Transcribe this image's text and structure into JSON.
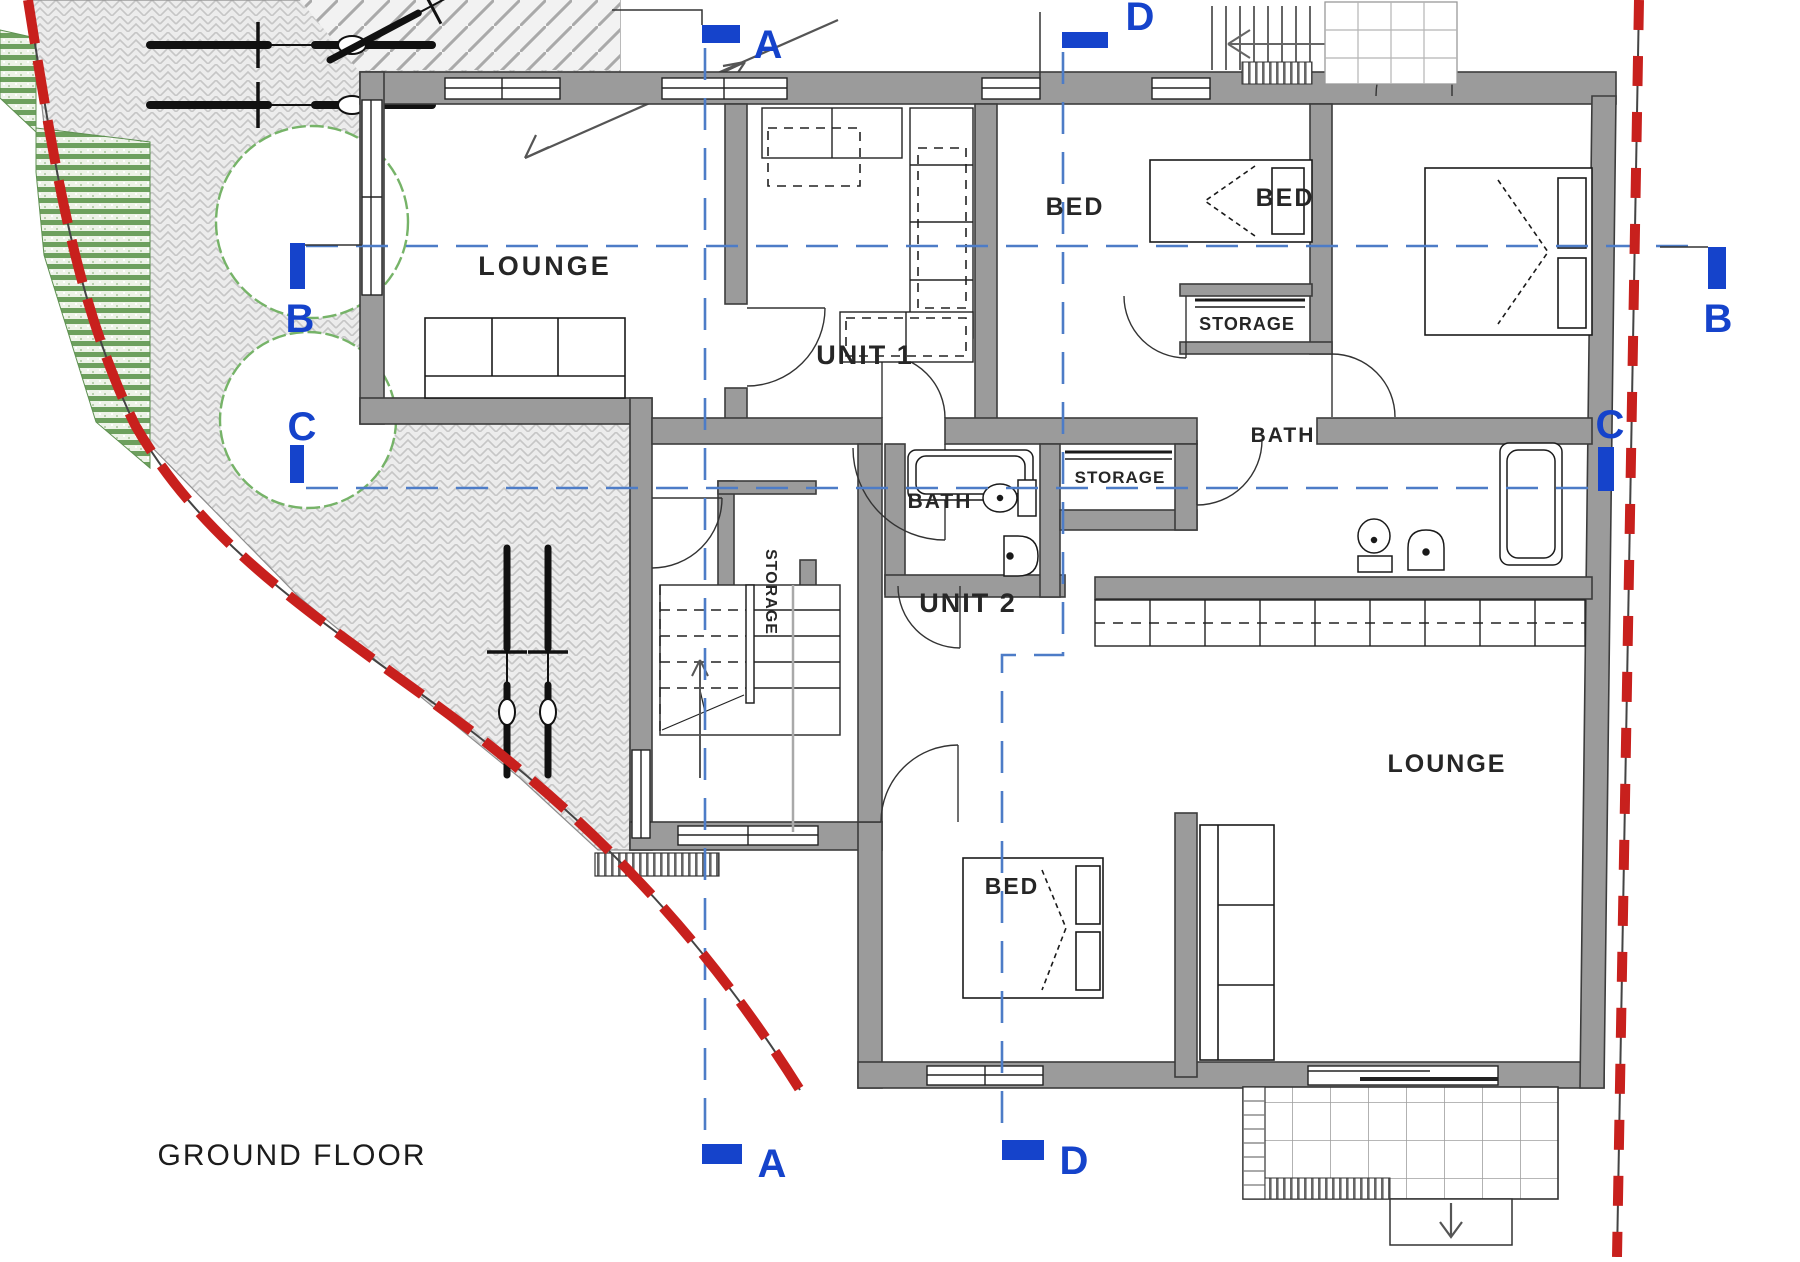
{
  "title": "GROUND FLOOR",
  "plan": {
    "floor_name": "GROUND FLOOR",
    "units": {
      "unit1": "UNIT 1",
      "unit2": "UNIT 2"
    },
    "rooms": {
      "lounge1": "LOUNGE",
      "lounge2": "LOUNGE",
      "bed1": "BED",
      "bed2": "BED",
      "bed3": "BED",
      "bath1": "BATH",
      "bath2": "BATH",
      "storage1": "STORAGE",
      "storage2": "STORAGE",
      "storage3": "STORAGE"
    },
    "section_markers": {
      "a_top": "A",
      "d_top": "D",
      "a_bottom": "A",
      "d_bottom": "D",
      "b_left": "B",
      "c_left": "C",
      "b_right": "B",
      "c_right": "C"
    },
    "colors": {
      "marker_blue": "#1543cb",
      "section_line_blue": "#4d7cc7",
      "boundary_red": "#c8201d",
      "wall_grey": "#9b9b9b",
      "landscape_green": "#6da05e",
      "paving_grey": "#ececec"
    }
  }
}
